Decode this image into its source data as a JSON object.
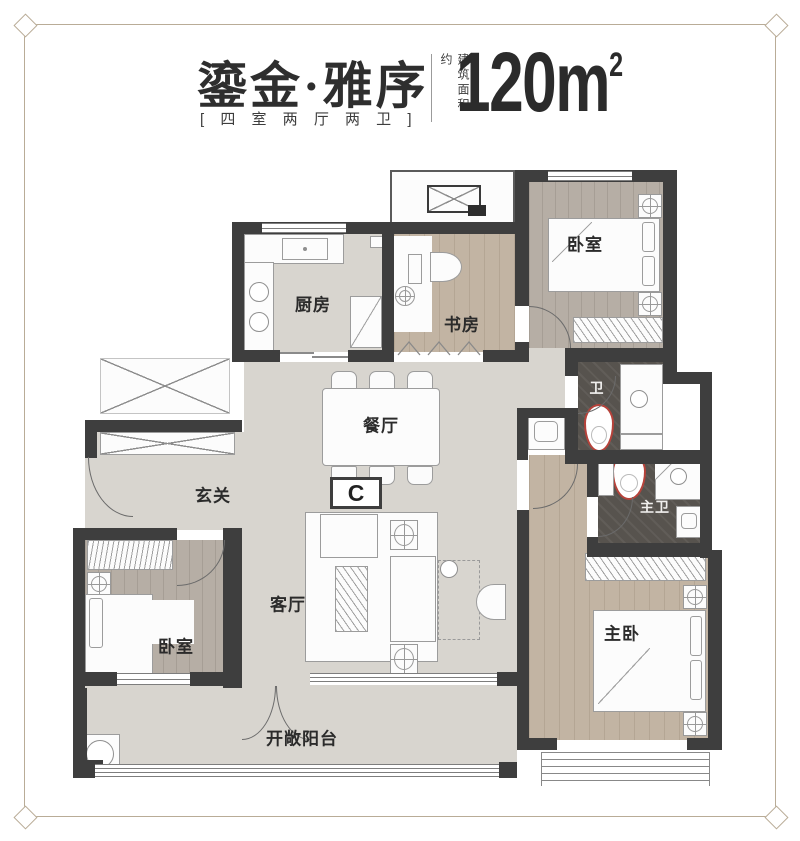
{
  "header": {
    "title": "鎏金·雅序",
    "subtitle": "[ 四 室 两 厅 两 卫 ]",
    "area_label": "建筑面积约",
    "area_value": "120m",
    "area_unit_sup": "2"
  },
  "plan": {
    "badge": "C",
    "rooms": {
      "bedroom_top": "卧室",
      "kitchen": "厨房",
      "study": "书房",
      "dining": "餐厅",
      "foyer": "玄关",
      "living": "客厅",
      "bedroom_left": "卧室",
      "master_bedroom": "主卧",
      "bath": "卫",
      "master_bath": "主卫",
      "balcony": "开敞阳台"
    }
  },
  "colors": {
    "wall": "#3e3e3e",
    "floor_light": "#d8d5cf",
    "floor_wood": "#c2b4a3",
    "floor_wood_gray": "#b6aea5",
    "floor_dark": "#57534e",
    "toilet_accent": "#b6423a",
    "frame": "#b9ac97",
    "text": "#2e2e2e"
  }
}
